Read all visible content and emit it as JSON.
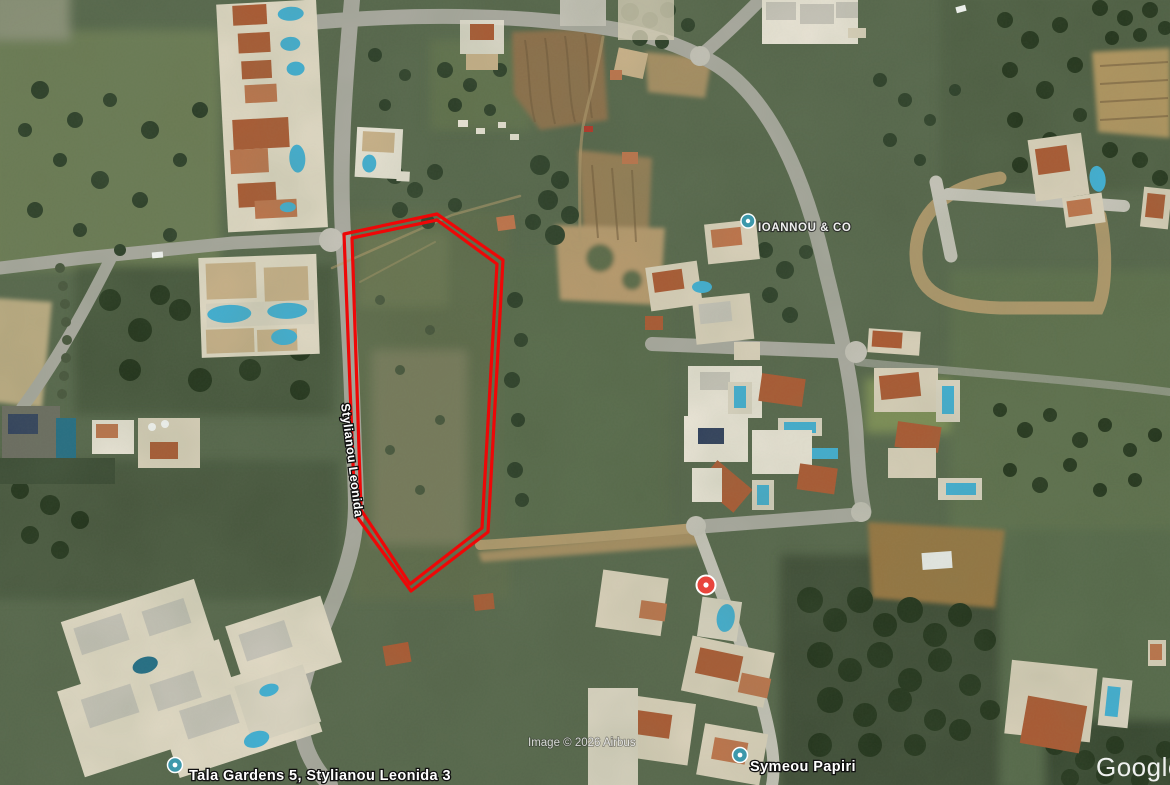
{
  "map": {
    "street_label": "Stylianou Leonida",
    "place_labels": [
      {
        "text": "IOANNOU & CO"
      },
      {
        "text": "Tala Gardens 5, Stylianou Leonida 3"
      },
      {
        "text": "Symeou Papiri"
      }
    ],
    "copyright": "Image © 2026 Airbus",
    "logo": "Google",
    "pin_teal_color": "#3d98ab",
    "pin_red_color": "#e8453c"
  },
  "parcel": {
    "color": "#ee0707",
    "outer_points": "344,234 437,214 503,260 488,532 411,591 355,514",
    "inner_points": "352,238 437,220 497,264 482,528 410,584 361,510"
  }
}
